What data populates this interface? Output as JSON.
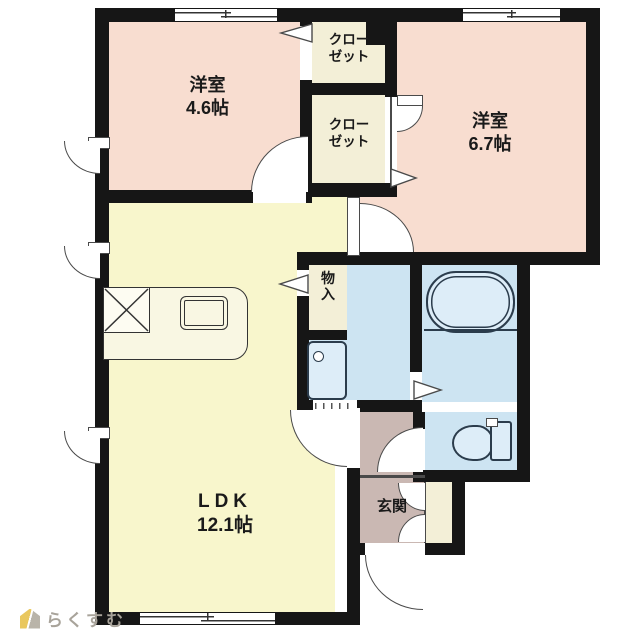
{
  "branding": {
    "logo_text": "らくすむ"
  },
  "labels": {
    "bedroom1_name": "洋室",
    "bedroom1_size": "4.6帖",
    "bedroom2_name": "洋室",
    "bedroom2_size": "6.7帖",
    "ldk_name": "LDK",
    "ldk_size": "12.1帖",
    "closet_line1": "クロー",
    "closet_line2": "ゼット",
    "storage": "物入",
    "entrance": "玄関"
  },
  "colors": {
    "wall": "#161616",
    "bedroom": "#f8ddd0",
    "ldk": "#f8f6cc",
    "closet": "#f3efd7",
    "water": "#cde4f2",
    "fixture": "#ddedf8",
    "hall": "#cab8b3",
    "line": "#4a4a4a",
    "logo_text": "#a8a39a",
    "logo_accent": "#e9c75e"
  }
}
